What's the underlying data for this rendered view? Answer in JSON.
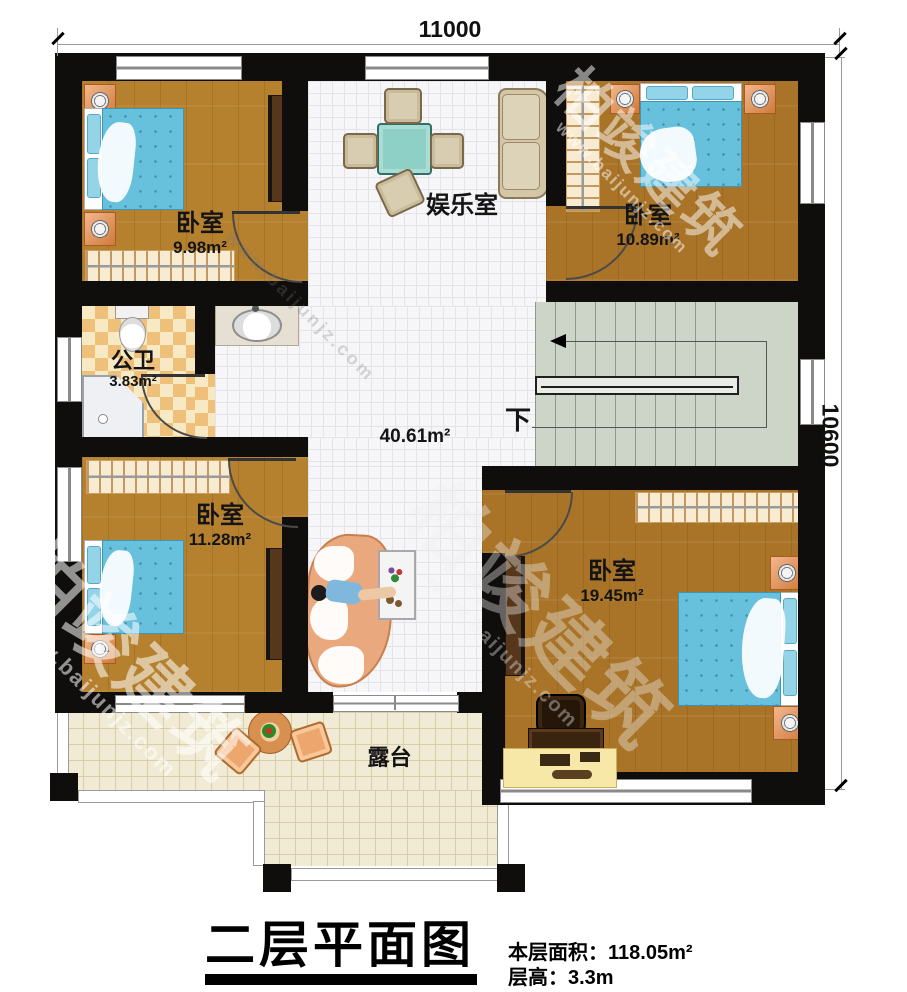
{
  "dimensions": {
    "top": "11000",
    "right": "10600"
  },
  "rooms": {
    "bedroom_tl": {
      "name": "卧室",
      "area": "9.98m²"
    },
    "bedroom_tr": {
      "name": "卧室",
      "area": "10.89m²"
    },
    "entertainment": {
      "name": "娱乐室"
    },
    "bathroom": {
      "name": "公卫",
      "area": "3.83m²"
    },
    "hall": {
      "area": "40.61m²"
    },
    "stairs": {
      "down_label": "下"
    },
    "bedroom_bl": {
      "name": "卧室",
      "area": "11.28m²"
    },
    "bedroom_br": {
      "name": "卧室",
      "area": "19.45m²"
    },
    "terrace": {
      "name": "露台"
    }
  },
  "title": {
    "text": "二层平面图",
    "floor_area_label": "本层面积：",
    "floor_area_value": "118.05m²",
    "floor_height_label": "层高：",
    "floor_height_value": "3.3m"
  },
  "watermark": {
    "brand": "柏竣建筑",
    "url": "www.baijunjz.com"
  },
  "colors": {
    "wall": "#0f0e0c",
    "wood": "#b5812f",
    "wood_dark": "#a97428",
    "tile": "#f6f6f8",
    "tile_line": "#e3e3e9",
    "checker_light": "#f7e9c4",
    "checker_dark": "#eec07a",
    "stairs_bg": "#ccd5c8",
    "stairs_line": "#8a9a85",
    "terrace_tile": "#f1ebd5",
    "terrace_line": "#d8cfaa",
    "bed_blue": "#67c0dc",
    "pillow_blue": "#93d4e8",
    "teal_table": "#8fd0c6",
    "sofa_beige": "#d3c7a8",
    "curved_sofa": "#e9a87d",
    "counter_yellow": "#f7e8a8"
  }
}
